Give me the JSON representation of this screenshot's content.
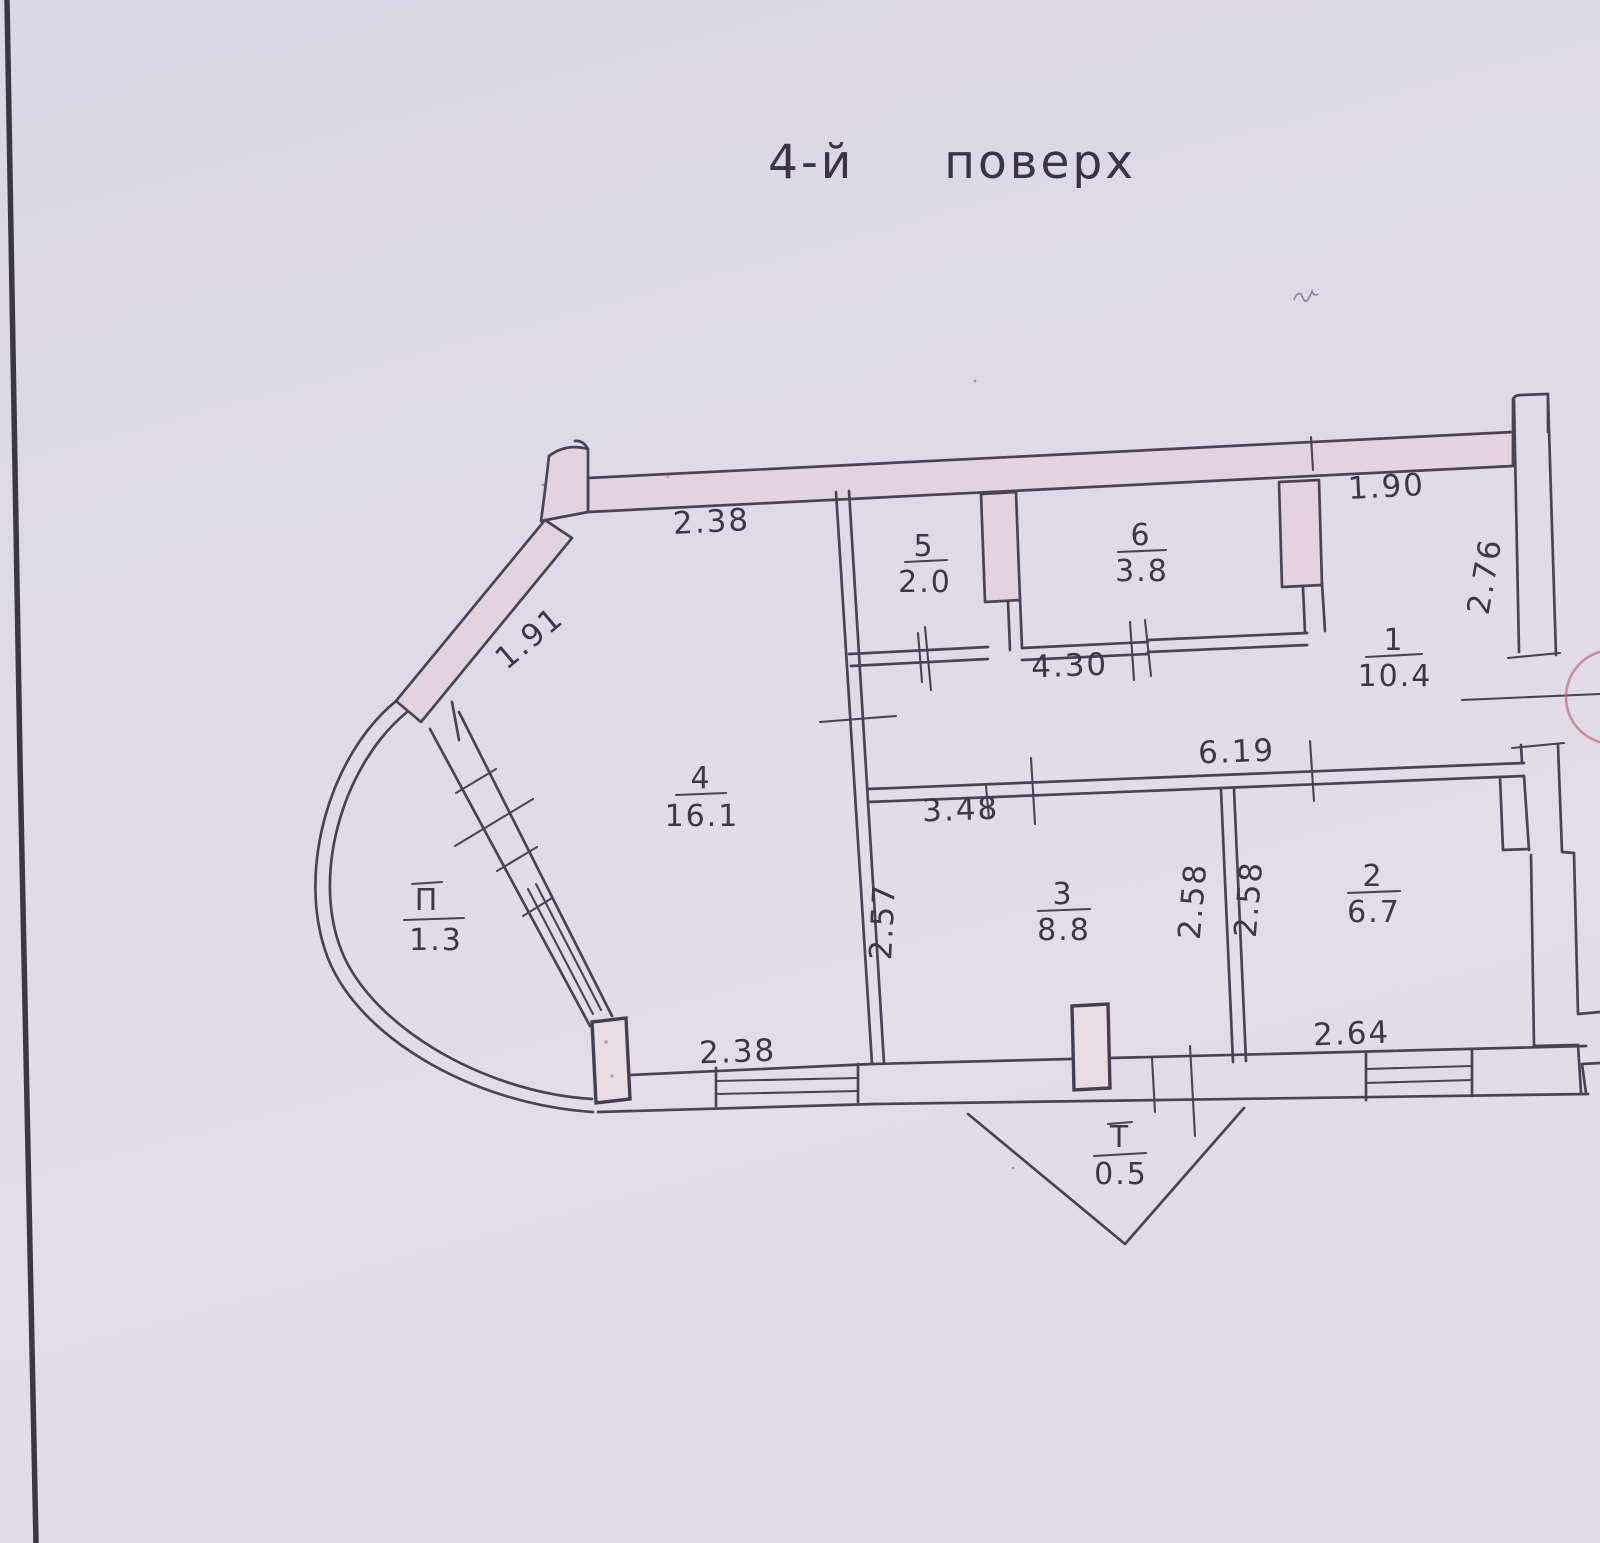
{
  "page": {
    "title": "4-й поверх"
  },
  "plan": {
    "rooms": {
      "r1": {
        "number": "1",
        "area": "10.4"
      },
      "r2": {
        "number": "2",
        "area": "6.7"
      },
      "r3": {
        "number": "3",
        "area": "8.8"
      },
      "r4": {
        "number": "4",
        "area": "16.1"
      },
      "r5": {
        "number": "5",
        "area": "2.0"
      },
      "r6": {
        "number": "6",
        "area": "3.8"
      },
      "balcony_p": {
        "number": "П",
        "area": "1.3"
      },
      "balcony_t": {
        "number": "Т",
        "area": "0.5"
      }
    },
    "dims": {
      "top_wall": "2.38",
      "diagonal_wall": "1.91",
      "closet_wall": "4.30",
      "entry_width": "1.90",
      "entry_height": "2.76",
      "hall_wall": "6.19",
      "room3_top": "3.48",
      "room3_left": "2.57",
      "room3_right": "2.58",
      "room2_left": "2.58",
      "room2_window": "2.64",
      "room4_window": "2.38"
    }
  }
}
